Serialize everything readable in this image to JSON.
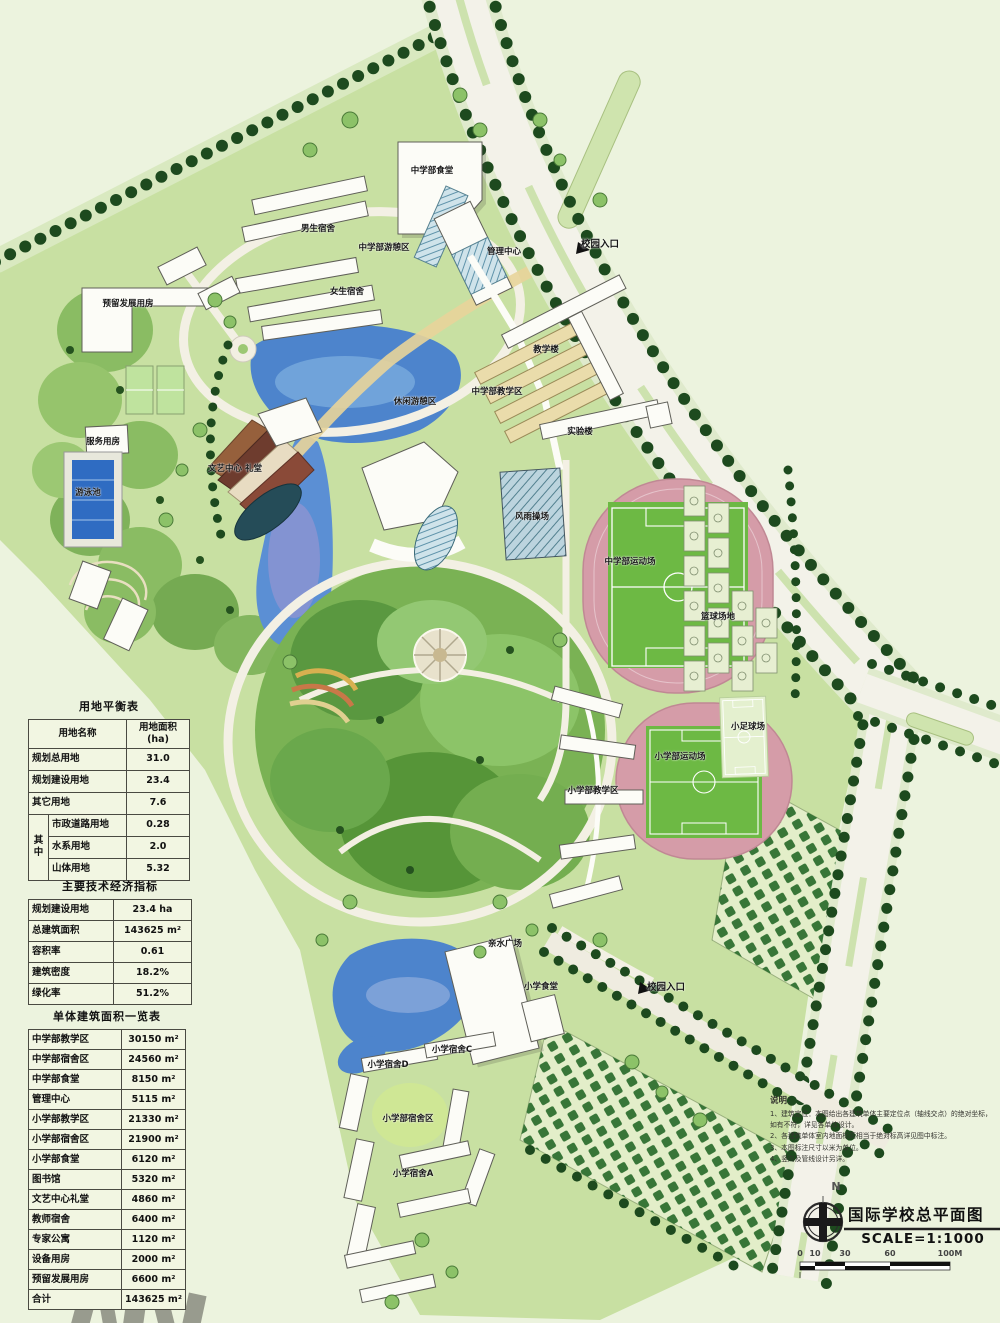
{
  "titleBlock": {
    "north_label": "N",
    "title": "国际学校总平面图",
    "scale": "SCALE=1:1000",
    "scalebar": {
      "ticks": [
        "0",
        "10",
        "30",
        "60",
        "100M"
      ]
    }
  },
  "tables": {
    "land_balance": {
      "title": "用地平衡表",
      "header": {
        "name": "用地名称",
        "area": "用地面积(ha)"
      },
      "rows": [
        {
          "name": "规划总用地",
          "value": "31.0"
        },
        {
          "name": "规划建设用地",
          "value": "23.4"
        },
        {
          "name": "其它用地",
          "value": "7.6"
        }
      ],
      "sub_label": "其中",
      "sub_rows": [
        {
          "name": "市政道路用地",
          "value": "0.28"
        },
        {
          "name": "水系用地",
          "value": "2.0"
        },
        {
          "name": "山体用地",
          "value": "5.32"
        }
      ]
    },
    "tech_indicators": {
      "title": "主要技术经济指标",
      "rows": [
        {
          "name": "规划建设用地",
          "value": "23.4 ha"
        },
        {
          "name": "总建筑面积",
          "value": "143625 m²"
        },
        {
          "name": "容积率",
          "value": "0.61"
        },
        {
          "name": "建筑密度",
          "value": "18.2%"
        },
        {
          "name": "绿化率",
          "value": "51.2%"
        }
      ]
    },
    "building_areas": {
      "title": "单体建筑面积一览表",
      "rows": [
        {
          "name": "中学部教学区",
          "value": "30150 m²"
        },
        {
          "name": "中学部宿舍区",
          "value": "24560 m²"
        },
        {
          "name": "中学部食堂",
          "value": "8150 m²"
        },
        {
          "name": "管理中心",
          "value": "5115 m²"
        },
        {
          "name": "小学部教学区",
          "value": "21330 m²"
        },
        {
          "name": "小学部宿舍区",
          "value": "21900 m²"
        },
        {
          "name": "小学部食堂",
          "value": "6120 m²"
        },
        {
          "name": "图书馆",
          "value": "5320 m²"
        },
        {
          "name": "文艺中心礼堂",
          "value": "4860 m²"
        },
        {
          "name": "教师宿舍",
          "value": "6400 m²"
        },
        {
          "name": "专家公寓",
          "value": "1120 m²"
        },
        {
          "name": "设备用房",
          "value": "2000 m²"
        },
        {
          "name": "预留发展用房",
          "value": "6600 m²"
        },
        {
          "name": "合计",
          "value": "143625 m²"
        }
      ]
    }
  },
  "notes": {
    "title": "说明：",
    "items": [
      "1、建筑定位：本图给出各建筑单体主要定位点（轴线交点）的绝对坐标，如有不符，详见各单体设计。",
      "2、各建筑单体室内地面标高相当于绝对标高详见图中标注。",
      "3、本图标注尺寸以米为单位。",
      "4、竖向及管线设计另详。"
    ]
  },
  "map": {
    "labels": [
      {
        "text": "校园入口"
      },
      {
        "text": "中学部食堂"
      },
      {
        "text": "男生宿舍"
      },
      {
        "text": "中学部游憩区"
      },
      {
        "text": "女生宿舍"
      },
      {
        "text": "预留发展用房"
      },
      {
        "text": "管理中心"
      },
      {
        "text": "休闲游憩区"
      },
      {
        "text": "教学楼"
      },
      {
        "text": "中学部教学区"
      },
      {
        "text": "实验楼"
      },
      {
        "text": "服务用房"
      },
      {
        "text": "游泳池"
      },
      {
        "text": "文艺中心 礼堂"
      },
      {
        "text": "风雨操场"
      },
      {
        "text": "中学部运动场"
      },
      {
        "text": "篮球场地"
      },
      {
        "text": "小学部运动场"
      },
      {
        "text": "小足球场"
      },
      {
        "text": "小学部教学区"
      },
      {
        "text": "亲水广场"
      },
      {
        "text": "小学食堂"
      },
      {
        "text": "校园入口"
      },
      {
        "text": "小学宿舍C"
      },
      {
        "text": "小学宿舍D"
      },
      {
        "text": "小学部宿舍区"
      },
      {
        "text": "小学宿舍A"
      }
    ]
  },
  "colors": {
    "background": "#ecf3de",
    "lawn": "#c8e0a2",
    "park_green": "#7ab254",
    "tree_dark": "#1d4a1e",
    "lake_blue": "#4d84cc",
    "track_pink": "#d59ca8",
    "pitch_green": "#6db944",
    "road": "#f3f2e9",
    "building": "#fcfcf7"
  }
}
